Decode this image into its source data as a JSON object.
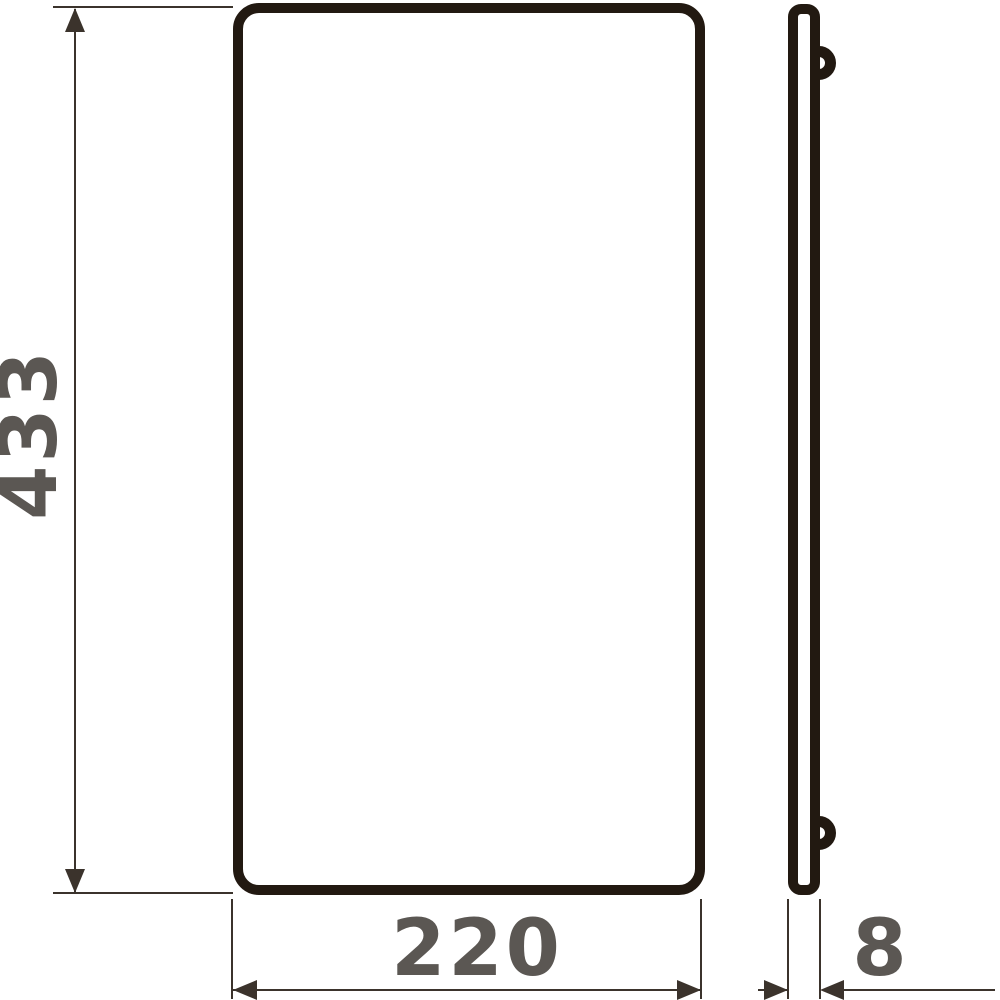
{
  "page": {
    "background_color": "#ffffff"
  },
  "drawing": {
    "type": "technical-dimension-drawing",
    "colors": {
      "outline": "#221911",
      "dimension_lines": "#3b332c",
      "dimension_text": "#5b5753"
    },
    "views": {
      "front": {
        "shape": "rounded-rectangle"
      },
      "side": {
        "shape": "thin-bar-with-two-pegs"
      }
    },
    "dimensions": {
      "height": "433",
      "width": "220",
      "thickness": "8"
    }
  }
}
